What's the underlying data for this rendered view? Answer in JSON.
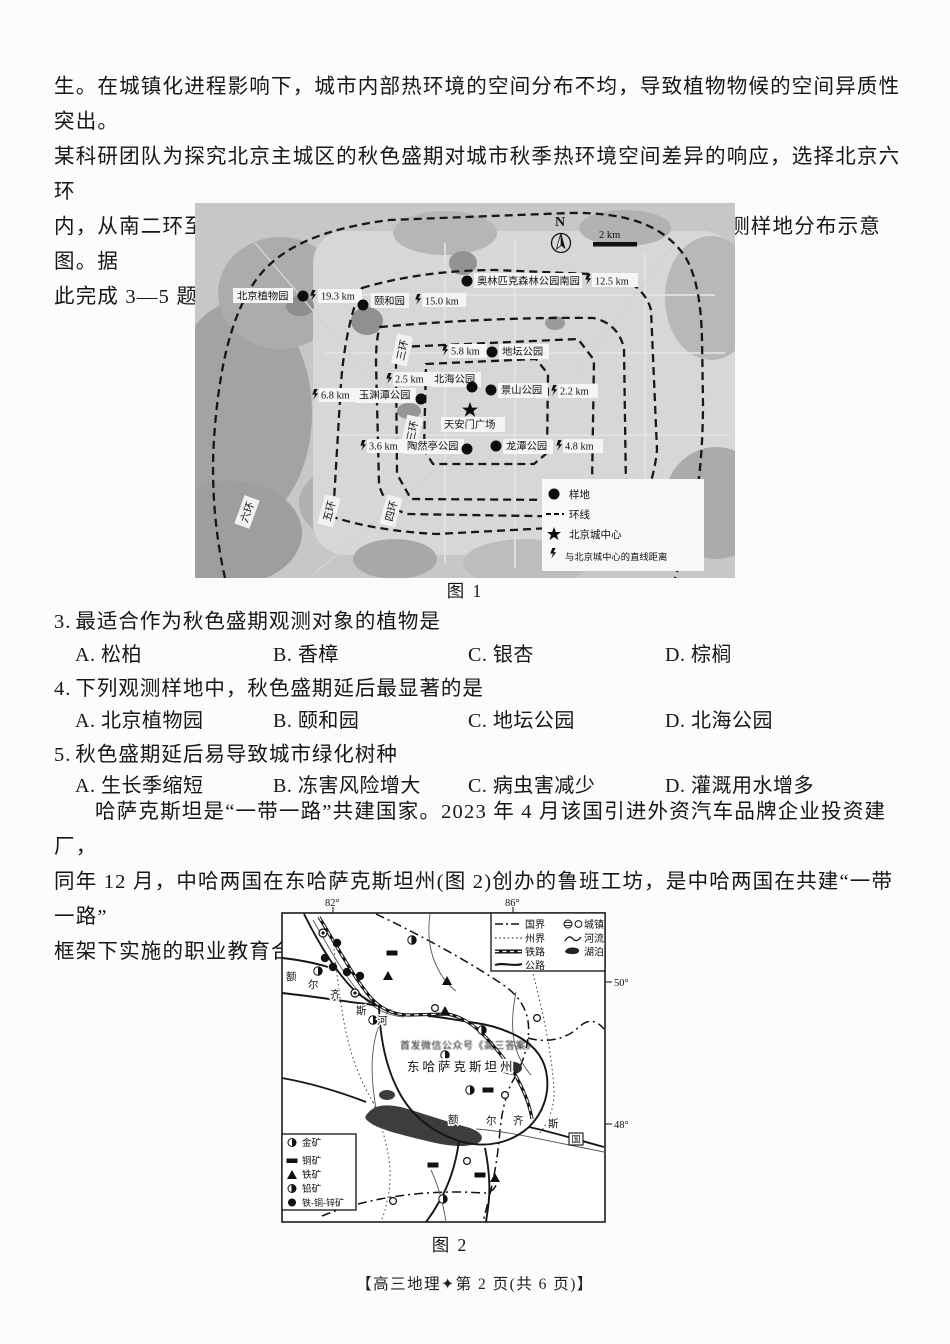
{
  "page": {
    "intro1": "生。在城镇化进程影响下，城市内部热环境的空间分布不均，导致植物物候的空间异质性突出。\n某科研团队为探究北京主城区的秋色盛期对城市秋季热环境空间差异的响应，选择北京六环\n内，从南二环至北—西北方向的多处城市绿地作为研究对象。图 1 为观测样地分布示意图。据\n此完成 3—5 题。",
    "intro2": "哈萨克斯坦是“一带一路”共建国家。2023 年 4 月该国引进外资汽车品牌企业投资建厂，\n同年 12 月，中哈两国在东哈萨克斯坦州(图 2)创办的鲁班工坊，是中哈两国在共建“一带一路”\n框架下实施的职业教育合作项目。据此完成 6—7 题。",
    "fig1_caption": "图 1",
    "fig2_caption": "图 2",
    "footer": "【高三地理✦第 2 页(共 6 页)】",
    "questions": [
      {
        "num": "3.",
        "stem": "最适合作为秋色盛期观测对象的植物是",
        "options": [
          "A. 松柏",
          "B. 香樟",
          "C. 银杏",
          "D. 棕榈"
        ]
      },
      {
        "num": "4.",
        "stem": "下列观测样地中，秋色盛期延后最显著的是",
        "options": [
          "A. 北京植物园",
          "B. 颐和园",
          "C. 地坛公园",
          "D. 北海公园"
        ]
      },
      {
        "num": "5.",
        "stem": "秋色盛期延后易导致城市绿化树种",
        "options": [
          "A. 生长季缩短",
          "B. 冻害风险增大",
          "C. 病虫害减少",
          "D. 灌溉用水增多"
        ]
      }
    ]
  },
  "map1": {
    "north": "N",
    "scale": "2 km",
    "rings": [
      "六环",
      "五环",
      "四环",
      "三环",
      "三环"
    ],
    "sites": [
      {
        "name": "北京植物园",
        "dist": "19.3 km"
      },
      {
        "name": "颐和园",
        "dist": "15.0 km"
      },
      {
        "name": "奥林匹克森林公园南园",
        "dist": "12.5 km"
      },
      {
        "name": "地坛公园",
        "dist": "5.8 km"
      },
      {
        "name": "北海公园",
        "dist": "2.5 km"
      },
      {
        "name": "景山公园",
        "dist": "2.2 km"
      },
      {
        "name": "玉渊潭公园",
        "dist": "6.8 km"
      },
      {
        "name": "陶然亭公园",
        "dist": "3.6 km"
      },
      {
        "name": "龙潭公园",
        "dist": "4.8 km"
      }
    ],
    "center_name": "天安门广场",
    "legend": {
      "sample": "样地",
      "ring": "环线",
      "center": "北京城中心",
      "distance": "与北京城中心的直线距离"
    }
  },
  "map2": {
    "lon": [
      "82°",
      "86°"
    ],
    "lat": [
      "50°",
      "48°"
    ],
    "legend": {
      "border": "国界",
      "state_border": "州界",
      "railway": "铁路",
      "road": "公路",
      "town": "城镇",
      "river": "河流",
      "lake": "湖泊"
    },
    "minerals": {
      "gold": "金矿",
      "copper": "铜矿",
      "iron": "铁矿",
      "lead": "铅矿",
      "fe_cu_zn": "铁-铜-锌矿"
    },
    "river_chars": [
      "额",
      "尔",
      "齐",
      "斯",
      "河"
    ],
    "river2_chars": [
      "额",
      "尔",
      "齐",
      "斯"
    ],
    "state_name": "东哈萨克斯坦州",
    "watermark": "首发微信公众号《高三答案》",
    "border_box": "国"
  }
}
